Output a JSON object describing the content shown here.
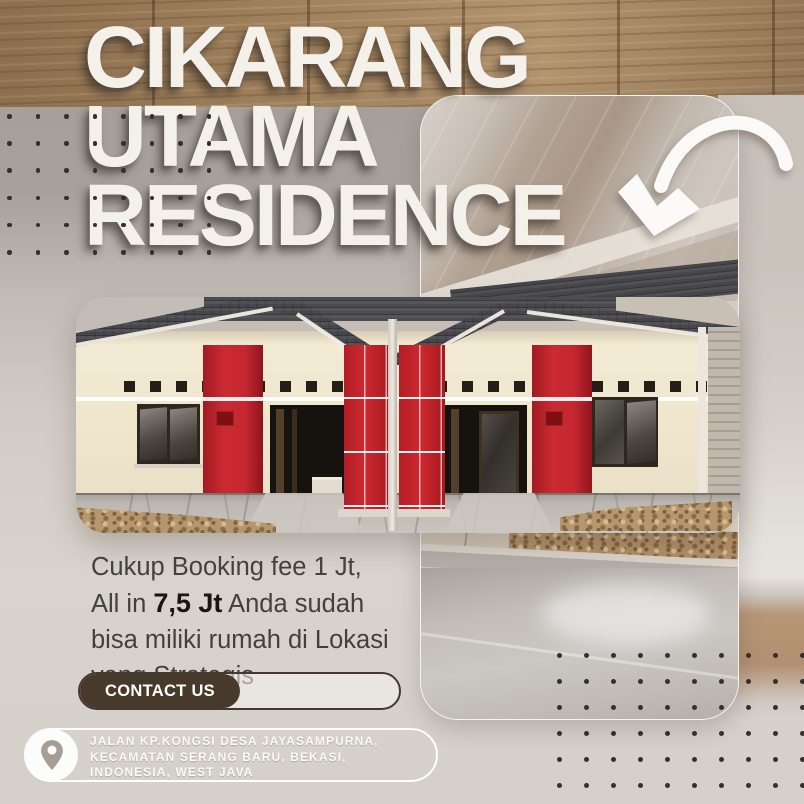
{
  "title": {
    "line1": "CIKARANG",
    "line2": "UTAMA",
    "line3": "RESIDENCE"
  },
  "promo": {
    "lines": [
      {
        "segments": [
          {
            "text": "Cukup Booking fee 1 Jt,",
            "bold": false
          }
        ]
      },
      {
        "segments": [
          {
            "text": "All in ",
            "bold": false
          },
          {
            "text": "7,5 Jt",
            "bold": true
          },
          {
            "text": " Anda sudah",
            "bold": false
          }
        ]
      },
      {
        "segments": [
          {
            "text": "bisa miliki rumah di Lokasi",
            "bold": false
          }
        ]
      },
      {
        "segments": [
          {
            "text": "yang Strategis",
            "bold": false
          }
        ]
      }
    ]
  },
  "contact": {
    "label": "CONTACT US"
  },
  "address": {
    "line1": "JALAN KP.KONGSI DESA JAYASAMPURNA,",
    "line2": "KECAMATAN SERANG BARU, BEKASI,",
    "line3": "INDONESIA, WEST JAVA"
  },
  "icons": {
    "arrow": "curved-arrow-down-left",
    "pin": "location-pin"
  },
  "colors": {
    "accent_red": "#c32329",
    "wood_brown": "#96785a",
    "button_brown": "#483a2a",
    "title_white": "#f4f1eb",
    "text_dark": "#43403d"
  }
}
